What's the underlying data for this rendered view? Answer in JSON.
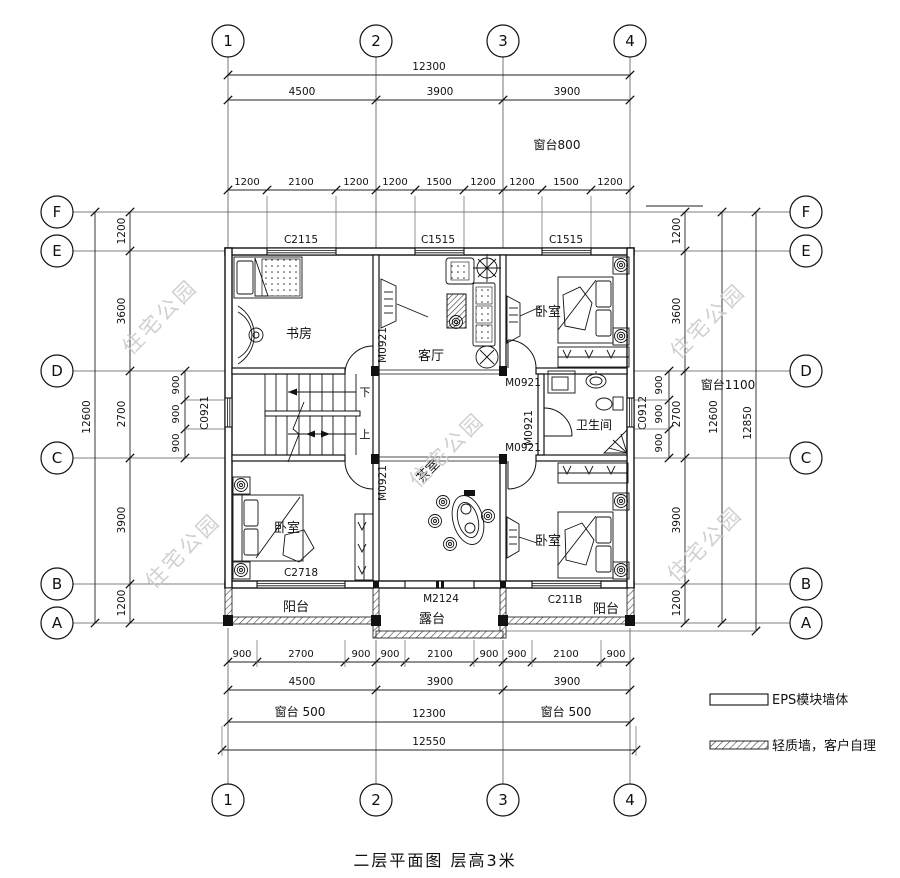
{
  "title": "二层平面图  层高3米",
  "watermark": "住宅公园",
  "grid": {
    "cols": [
      "1",
      "2",
      "3",
      "4"
    ],
    "rows": [
      "F",
      "E",
      "D",
      "C",
      "B",
      "A"
    ]
  },
  "dims": {
    "top": {
      "total": "12300",
      "segments": [
        "4500",
        "3900",
        "3900"
      ],
      "small": [
        "1200",
        "2100",
        "1200",
        "1200",
        "1500",
        "1200",
        "1200",
        "1500",
        "1200"
      ],
      "sill": "窗台800"
    },
    "bottom": {
      "small": [
        "900",
        "2700",
        "900",
        "900",
        "2100",
        "900",
        "900",
        "2100",
        "900"
      ],
      "segments": [
        "4500",
        "3900",
        "3900"
      ],
      "sill": "窗台 500",
      "inner_total": "12300",
      "outer_total": "12550"
    },
    "left": {
      "segments": [
        "1200",
        "3600",
        "2700",
        "3900",
        "1200"
      ],
      "total": "12600",
      "inner": [
        "900",
        "900",
        "900"
      ]
    },
    "right": {
      "segments": [
        "1200",
        "3600",
        "2700",
        "3900",
        "1200"
      ],
      "total": "12600",
      "outer_total": "12850",
      "inner": [
        "900",
        "900",
        "900"
      ],
      "sill": "窗台1100"
    }
  },
  "rooms": {
    "study": "书房",
    "living": "客厅",
    "bedroom": "卧室",
    "bath": "卫生间",
    "tea": "茶室",
    "balcony": "阳台",
    "terrace": "露台"
  },
  "stairs": {
    "down": "下",
    "up": "上"
  },
  "openings": {
    "c2115": "C2115",
    "c1515": "C1515",
    "c0921": "C0921",
    "c0912": "C0912",
    "c2718": "C2718",
    "c2118": "C211B",
    "m0921": "M0921",
    "m2124": "M2124"
  },
  "legend": {
    "eps": "EPS模块墙体",
    "light": "轻质墙，客户自理"
  }
}
